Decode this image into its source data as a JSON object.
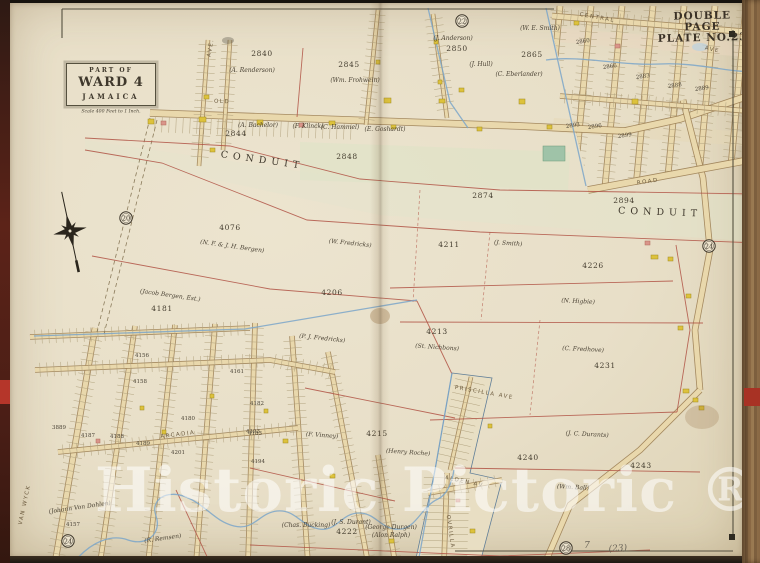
{
  "plate": {
    "line1": "DOUBLE PAGE",
    "line2": "PLATE NO.23"
  },
  "cartouche": {
    "part_of": "PART OF",
    "ward": "WARD 4",
    "place": "JAMAICA",
    "scale": "Scale 400 Feet to 1 Inch."
  },
  "watermark": {
    "text": "Historic Pictoric ®",
    "color": "rgba(255,255,255,0.55)"
  },
  "colors": {
    "paper": "#eae2cc",
    "road_fill": "#e9d8ac",
    "road_edge": "#9c8054",
    "parcel_line": "#b05244",
    "water": "#7ba6c9",
    "ink": "#3d362a",
    "building_wood": "#ddc23c",
    "building_brick": "#d9958a",
    "building_special": "#9fc3a8"
  },
  "map": {
    "labels": [
      {
        "t": "2840",
        "x": 262,
        "y": 56,
        "s": "n"
      },
      {
        "t": "2845",
        "x": 349,
        "y": 67,
        "s": "n"
      },
      {
        "t": "2850",
        "x": 457,
        "y": 51,
        "s": "n"
      },
      {
        "t": "2865",
        "x": 532,
        "y": 57,
        "s": "n"
      },
      {
        "t": "2844",
        "x": 236,
        "y": 136,
        "s": "n"
      },
      {
        "t": "2848",
        "x": 347,
        "y": 159,
        "s": "n"
      },
      {
        "t": "2874",
        "x": 483,
        "y": 198,
        "s": "n"
      },
      {
        "t": "2894",
        "x": 624,
        "y": 203,
        "s": "n"
      },
      {
        "t": "4076",
        "x": 230,
        "y": 230,
        "s": "n"
      },
      {
        "t": "4206",
        "x": 332,
        "y": 295,
        "s": "n"
      },
      {
        "t": "4181",
        "x": 162,
        "y": 311,
        "s": "n"
      },
      {
        "t": "4211",
        "x": 449,
        "y": 247,
        "s": "n"
      },
      {
        "t": "4226",
        "x": 593,
        "y": 268,
        "s": "n"
      },
      {
        "t": "4213",
        "x": 437,
        "y": 334,
        "s": "n"
      },
      {
        "t": "4231",
        "x": 605,
        "y": 368,
        "s": "n"
      },
      {
        "t": "4240",
        "x": 528,
        "y": 460,
        "s": "n"
      },
      {
        "t": "4243",
        "x": 641,
        "y": 468,
        "s": "n"
      },
      {
        "t": "4215",
        "x": 377,
        "y": 436,
        "s": "n"
      },
      {
        "t": "4222",
        "x": 347,
        "y": 534,
        "s": "n"
      },
      {
        "t": "4156",
        "x": 142,
        "y": 357,
        "s": "n2"
      },
      {
        "t": "4158",
        "x": 140,
        "y": 383,
        "s": "n2"
      },
      {
        "t": "4161",
        "x": 237,
        "y": 373,
        "s": "n2"
      },
      {
        "t": "4180",
        "x": 188,
        "y": 420,
        "s": "n2"
      },
      {
        "t": "4182",
        "x": 257,
        "y": 405,
        "s": "n2"
      },
      {
        "t": "4183",
        "x": 255,
        "y": 435,
        "s": "n2"
      },
      {
        "t": "3889",
        "x": 59,
        "y": 429,
        "s": "n2"
      },
      {
        "t": "4187",
        "x": 88,
        "y": 437,
        "s": "n2"
      },
      {
        "t": "4188",
        "x": 117,
        "y": 438,
        "s": "n2"
      },
      {
        "t": "4189",
        "x": 143,
        "y": 445,
        "s": "n2"
      },
      {
        "t": "4201",
        "x": 178,
        "y": 454,
        "s": "n2"
      },
      {
        "t": "4193",
        "x": 253,
        "y": 433,
        "s": "n2"
      },
      {
        "t": "4194",
        "x": 258,
        "y": 463,
        "s": "n2"
      },
      {
        "t": "4157",
        "x": 73,
        "y": 526,
        "s": "n2"
      },
      {
        "t": "2860",
        "x": 583,
        "y": 43,
        "s": "n2",
        "r": -8
      },
      {
        "t": "2866",
        "x": 610,
        "y": 68,
        "s": "n2",
        "r": -8
      },
      {
        "t": "2883",
        "x": 643,
        "y": 78,
        "s": "n2",
        "r": -8
      },
      {
        "t": "2888",
        "x": 675,
        "y": 87,
        "s": "n2",
        "r": -8
      },
      {
        "t": "2889",
        "x": 702,
        "y": 90,
        "s": "n2",
        "r": -8
      },
      {
        "t": "2893",
        "x": 573,
        "y": 127,
        "s": "n2",
        "r": -8
      },
      {
        "t": "2896",
        "x": 595,
        "y": 128,
        "s": "n2",
        "r": -8
      },
      {
        "t": "2899",
        "x": 625,
        "y": 137,
        "s": "n2",
        "r": -8
      },
      {
        "t": "(A. Renderson)",
        "x": 252,
        "y": 72,
        "s": "o"
      },
      {
        "t": "(Wm. Frohwein)",
        "x": 355,
        "y": 82,
        "s": "o"
      },
      {
        "t": "(J. Anderson)",
        "x": 453,
        "y": 40,
        "s": "o"
      },
      {
        "t": "(W. E. Smith)",
        "x": 540,
        "y": 30,
        "s": "o"
      },
      {
        "t": "(J. Hull)",
        "x": 481,
        "y": 66,
        "s": "o"
      },
      {
        "t": "(C. Eberlander)",
        "x": 519,
        "y": 76,
        "s": "o"
      },
      {
        "t": "(A. Bachelor)",
        "x": 258,
        "y": 127,
        "s": "o"
      },
      {
        "t": "(F. Klinck)",
        "x": 308,
        "y": 128,
        "s": "o"
      },
      {
        "t": "(C. Hammel)",
        "x": 340,
        "y": 129,
        "s": "o"
      },
      {
        "t": "(E. Goshardt)",
        "x": 385,
        "y": 131,
        "s": "o"
      },
      {
        "t": "(N. F. & J. H. Bergen)",
        "x": 232,
        "y": 248,
        "s": "o",
        "r": 8
      },
      {
        "t": "(W. Fredricks)",
        "x": 350,
        "y": 245,
        "s": "o",
        "r": 6
      },
      {
        "t": "(Jacob Bergen, Est.)",
        "x": 170,
        "y": 297,
        "s": "o",
        "r": 8
      },
      {
        "t": "(J. Smith)",
        "x": 508,
        "y": 245,
        "s": "o",
        "r": 4
      },
      {
        "t": "(St. Nichbons)",
        "x": 437,
        "y": 349,
        "s": "o",
        "r": 4
      },
      {
        "t": "(P. J. Fredricks)",
        "x": 322,
        "y": 340,
        "s": "o",
        "r": 6
      },
      {
        "t": "(N. Higbie)",
        "x": 578,
        "y": 303,
        "s": "o",
        "r": 3
      },
      {
        "t": "(C. Fredhove)",
        "x": 583,
        "y": 351,
        "s": "o",
        "r": 3
      },
      {
        "t": "(J. C. Durants)",
        "x": 587,
        "y": 436,
        "s": "o",
        "r": 3
      },
      {
        "t": "(Wm. Ball)",
        "x": 573,
        "y": 489,
        "s": "o",
        "r": 3
      },
      {
        "t": "(F. Vinney)",
        "x": 322,
        "y": 437,
        "s": "o",
        "r": 4
      },
      {
        "t": "(Henry Roche)",
        "x": 408,
        "y": 454,
        "s": "o",
        "r": 4
      },
      {
        "t": "(J. S. Durant)",
        "x": 351,
        "y": 524,
        "s": "o"
      },
      {
        "t": "(Chas. Bucking)",
        "x": 306,
        "y": 527,
        "s": "o"
      },
      {
        "t": "(George Durgen)",
        "x": 391,
        "y": 529,
        "s": "o"
      },
      {
        "t": "(Alon Ralph)",
        "x": 391,
        "y": 537,
        "s": "o"
      },
      {
        "t": "(Johann Von Dohlen)",
        "x": 80,
        "y": 509,
        "s": "o",
        "r": -8
      },
      {
        "t": "(R. Remsen)",
        "x": 163,
        "y": 540,
        "s": "o",
        "r": -8
      },
      {
        "t": "OLD",
        "x": 222,
        "y": 103,
        "s": "s",
        "r": 2
      },
      {
        "t": "ROAD",
        "x": 648,
        "y": 183,
        "s": "s",
        "r": -8
      },
      {
        "t": "CENTRAL",
        "x": 597,
        "y": 19,
        "s": "s",
        "r": 10
      },
      {
        "t": "AVE",
        "x": 712,
        "y": 51,
        "s": "s",
        "r": 12
      },
      {
        "t": "AVE.",
        "x": 212,
        "y": 48,
        "s": "s",
        "r": -80
      },
      {
        "t": "ARCADIA",
        "x": 178,
        "y": 436,
        "s": "s",
        "r": -7
      },
      {
        "t": "VAN WYCK",
        "x": 26,
        "y": 505,
        "s": "s",
        "r": -78
      },
      {
        "t": "PRISCILLA AVE",
        "x": 484,
        "y": 394,
        "s": "s",
        "r": 10
      },
      {
        "t": "ALDEN AV",
        "x": 464,
        "y": 483,
        "s": "s",
        "r": 12
      },
      {
        "t": "OVRILLA",
        "x": 449,
        "y": 532,
        "s": "s",
        "r": 82
      },
      {
        "t": "CONDUIT",
        "x": 262,
        "y": 163,
        "s": "c",
        "r": 8
      },
      {
        "t": "CONDUIT",
        "x": 660,
        "y": 215,
        "s": "c",
        "r": 2
      }
    ],
    "ref_circles": [
      {
        "n": "22",
        "x": 462,
        "y": 21
      },
      {
        "n": "20",
        "x": 126,
        "y": 218
      },
      {
        "n": "24",
        "x": 709,
        "y": 246
      },
      {
        "n": "24",
        "x": 68,
        "y": 541
      },
      {
        "n": "28",
        "x": 566,
        "y": 548
      }
    ],
    "pencil_notes": [
      {
        "t": "(23)",
        "x": 618,
        "y": 551,
        "r": -4
      },
      {
        "t": "7",
        "x": 587,
        "y": 548,
        "r": 0
      }
    ],
    "buildings": [
      [
        148,
        119,
        6,
        5,
        "w"
      ],
      [
        161,
        121,
        5,
        4,
        "b"
      ],
      [
        199,
        117,
        7,
        5,
        "w"
      ],
      [
        204,
        95,
        5,
        4,
        "w"
      ],
      [
        257,
        120,
        6,
        5,
        "w"
      ],
      [
        299,
        123,
        5,
        4,
        "b"
      ],
      [
        329,
        121,
        6,
        4,
        "w"
      ],
      [
        384,
        98,
        7,
        5,
        "w"
      ],
      [
        391,
        125,
        5,
        4,
        "w"
      ],
      [
        439,
        99,
        6,
        4,
        "w"
      ],
      [
        477,
        127,
        5,
        4,
        "w"
      ],
      [
        519,
        99,
        6,
        5,
        "w"
      ],
      [
        547,
        125,
        5,
        4,
        "w"
      ],
      [
        543,
        146,
        22,
        15,
        "s"
      ],
      [
        632,
        99,
        6,
        5,
        "w"
      ],
      [
        574,
        21,
        5,
        4,
        "w"
      ],
      [
        615,
        44,
        5,
        4,
        "b"
      ],
      [
        645,
        241,
        5,
        4,
        "b"
      ],
      [
        651,
        255,
        7,
        4,
        "w"
      ],
      [
        668,
        257,
        5,
        4,
        "w"
      ],
      [
        686,
        294,
        5,
        4,
        "w"
      ],
      [
        678,
        326,
        5,
        4,
        "w"
      ],
      [
        683,
        389,
        6,
        4,
        "w"
      ],
      [
        693,
        398,
        5,
        4,
        "w"
      ],
      [
        699,
        406,
        5,
        4,
        "w"
      ],
      [
        459,
        88,
        5,
        4,
        "w"
      ],
      [
        434,
        40,
        4,
        4,
        "w"
      ],
      [
        438,
        80,
        4,
        4,
        "w"
      ],
      [
        376,
        60,
        4,
        4,
        "w"
      ],
      [
        210,
        148,
        5,
        4,
        "w"
      ],
      [
        162,
        430,
        4,
        4,
        "w"
      ],
      [
        210,
        394,
        4,
        4,
        "w"
      ],
      [
        264,
        409,
        4,
        4,
        "w"
      ],
      [
        140,
        406,
        4,
        4,
        "w"
      ],
      [
        96,
        439,
        4,
        4,
        "b"
      ],
      [
        283,
        439,
        5,
        4,
        "w"
      ],
      [
        330,
        474,
        5,
        4,
        "w"
      ],
      [
        389,
        539,
        5,
        4,
        "w"
      ],
      [
        488,
        424,
        4,
        4,
        "w"
      ],
      [
        470,
        529,
        5,
        4,
        "w"
      ],
      [
        456,
        499,
        4,
        3,
        "b"
      ]
    ]
  }
}
